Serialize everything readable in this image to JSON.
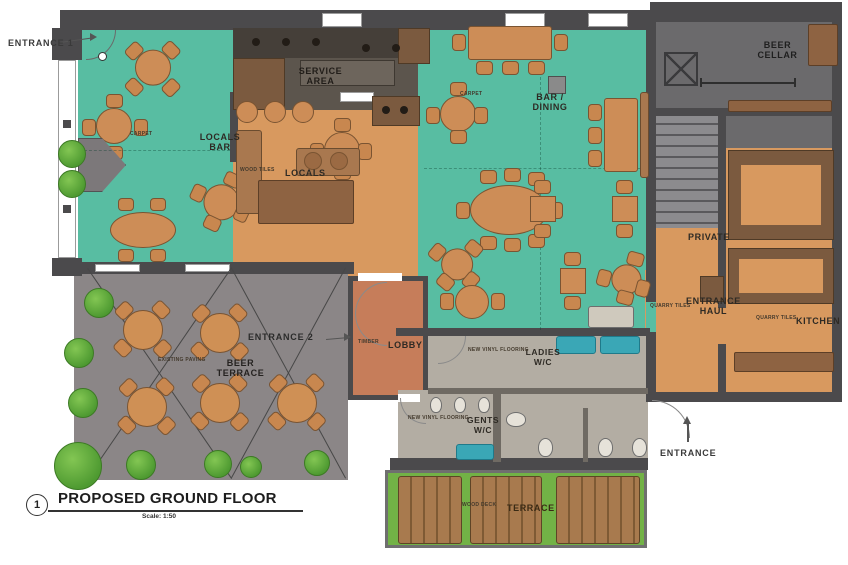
{
  "title_block": {
    "number": "1",
    "title": "PROPOSED GROUND FLOOR",
    "scale": "Scale: 1:50"
  },
  "rooms": {
    "locals_bar": {
      "label": "LOCALS BAR",
      "sublabel": "CARPET"
    },
    "service_area": {
      "label": "SERVICE AREA",
      "sublabel": ""
    },
    "locals": {
      "label": "LOCALS",
      "sublabel": "WOOD TILES"
    },
    "bar_dining": {
      "label": "BAR / DINING",
      "sublabel": "CARPET"
    },
    "beer_cellar": {
      "label": "BEER CELLAR",
      "sublabel": ""
    },
    "private": {
      "label": "PRIVATE",
      "sublabel": ""
    },
    "kitchen": {
      "label": "KITCHEN",
      "sublabel": "QUARRY TILES"
    },
    "entrance_haul": {
      "label": "ENTRANCE HAUL",
      "sublabel": "QUARRY TILES"
    },
    "lobby": {
      "label": "LOBBY",
      "sublabel": "TIMBER"
    },
    "ladies_wc": {
      "label": "LADIES W/C",
      "sublabel": "NEW VINYL FLOORING"
    },
    "gents_wc": {
      "label": "GENTS W/C",
      "sublabel": "NEW VINYL FLOORING"
    },
    "beer_terrace": {
      "label": "BEER TERRACE",
      "sublabel": "EXISTING PAVING"
    },
    "terrace": {
      "label": "TERRACE",
      "sublabel": "WOOD DECK"
    }
  },
  "annotations": {
    "entrance_1": "ENTRANCE 1",
    "entrance_2": "ENTRANCE 2",
    "entrance": "ENTRANCE"
  },
  "colors": {
    "teal_floor": "#58bda2",
    "tan_floor": "#d8995f",
    "lobby_floor": "#c67d5a",
    "terrace_gray": "#8b8687",
    "wc_floor": "#b3ada3",
    "cellar_gray": "#6b6a6c",
    "wall": "#4b4a4c",
    "deck_green": "#72b246",
    "plank_brown": "#a87a4e",
    "furniture": "#cd8d57",
    "fixture_teal": "#3aa7b6",
    "bush_green": "#5aa637"
  }
}
